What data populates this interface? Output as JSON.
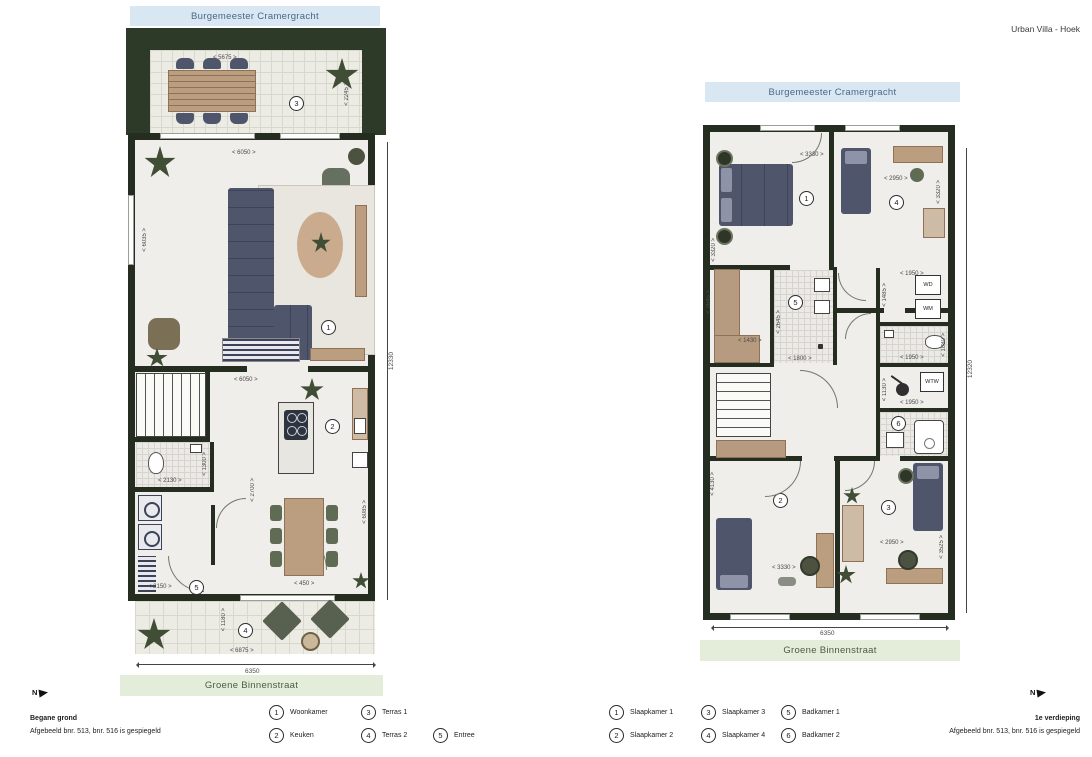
{
  "page": {
    "title": "Urban Villa - Hoek"
  },
  "colors": {
    "banner_blue_bg": "#d9e7f3",
    "banner_blue_text": "#46688a",
    "banner_green_bg": "#e4ecda",
    "banner_green_text": "#4c5d44",
    "wall": "#242d1f",
    "hedge": "#2d3a27",
    "floor": "#efeeea",
    "furniture_blue": "#4f566c",
    "wood": "#bb9d7f",
    "plant_green": "#3f4e35"
  },
  "ground_floor": {
    "street_top": "Burgemeester Cramergracht",
    "street_bottom": "Groene Binnenstraat",
    "floor_label": "Begane grond",
    "mirror_note": "Afgebeeld bnr. 513, bnr. 516 is gespiegeld",
    "north_label": "N",
    "dims": {
      "total_width": "6350",
      "total_height": "12330",
      "terrace_top_width": "< 5675 >",
      "terrace_top_depth": "< 2245 >",
      "living_width": "< 6050 >",
      "living_height": "< 6035 >",
      "kitchen_width": "< 6050 >",
      "kitchen_height": "< 6085 >",
      "wc_width": "< 2130 >",
      "wc_height": "< 1300 >",
      "hall_height": "< 2700 >",
      "entry_width": "< 2150 >",
      "table_offset": "< 450 >",
      "terrace_bottom_width": "< 6875 >",
      "terrace_bottom_depth": "< 1180 >"
    }
  },
  "first_floor": {
    "street_top": "Burgemeester Cramergracht",
    "street_bottom": "Groene Binnenstraat",
    "floor_label": "1e verdieping",
    "mirror_note": "Afgebeeld bnr. 513, bnr. 516 is gespiegeld",
    "north_label": "N",
    "labels": {
      "wd": "WD",
      "wm": "WM",
      "wtw": "WTW"
    },
    "dims": {
      "total_width": "6350",
      "total_height": "12320",
      "bed1_width": "< 3330 >",
      "bed1_height": "< 3320 >",
      "bed4_width": "< 2950 >",
      "bed4_height": "< 3320 >",
      "closet_height": "< 2645 >",
      "closet_width": "< 1430 >",
      "bath1_height": "< 2645 >",
      "bath1_width": "< 1800 >",
      "wdwm_width": "< 1950 >",
      "wdwm_height": "< 1485 >",
      "wc_width": "< 1950 >",
      "wc_height": "< 1080 >",
      "wtw_height": "< 1130 >",
      "wtw_width": "< 1950 >",
      "bed2_width": "< 3330 >",
      "bed2_height": "< 4130 >",
      "bed3_width": "< 2950 >",
      "bed3_height": "< 3525 >"
    }
  },
  "legend_ground": [
    {
      "num": "1",
      "label": "Woonkamer"
    },
    {
      "num": "2",
      "label": "Keuken"
    },
    {
      "num": "3",
      "label": "Terras 1"
    },
    {
      "num": "4",
      "label": "Terras 2"
    },
    {
      "num": "5",
      "label": "Entree"
    }
  ],
  "legend_first": [
    {
      "num": "1",
      "label": "Slaapkamer 1"
    },
    {
      "num": "2",
      "label": "Slaapkamer 2"
    },
    {
      "num": "3",
      "label": "Slaapkamer 3"
    },
    {
      "num": "4",
      "label": "Slaapkamer 4"
    },
    {
      "num": "5",
      "label": "Badkamer 1"
    },
    {
      "num": "6",
      "label": "Badkamer 2"
    }
  ]
}
